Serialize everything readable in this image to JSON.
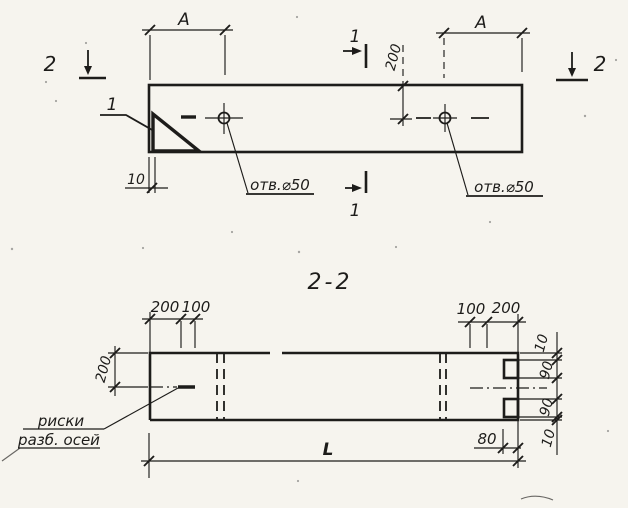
{
  "colors": {
    "ink": "#1d1c1a",
    "paper": "#f6f4ee"
  },
  "top_view": {
    "dim_a_left": "А",
    "dim_a_right": "А",
    "dim_200": "200",
    "dim_10": "10",
    "hole_label_left": "отв.⌀50",
    "hole_label_right": "отв.⌀50",
    "marker_1_top": "1",
    "marker_1_bottom": "1",
    "marker_2_left": "2",
    "marker_2_right": "2",
    "callout_1": "1"
  },
  "section_view": {
    "title": "2-2",
    "dim_top_left_200": "200",
    "dim_top_left_100": "100",
    "dim_top_right_100": "100",
    "dim_top_right_200": "200",
    "dim_left_200": "200",
    "dim_chain": [
      "10",
      "90",
      "90",
      "10"
    ],
    "dim_80": "80",
    "dim_L": "L",
    "axis_note_line1": "риски",
    "axis_note_line2": "разб. осей"
  }
}
